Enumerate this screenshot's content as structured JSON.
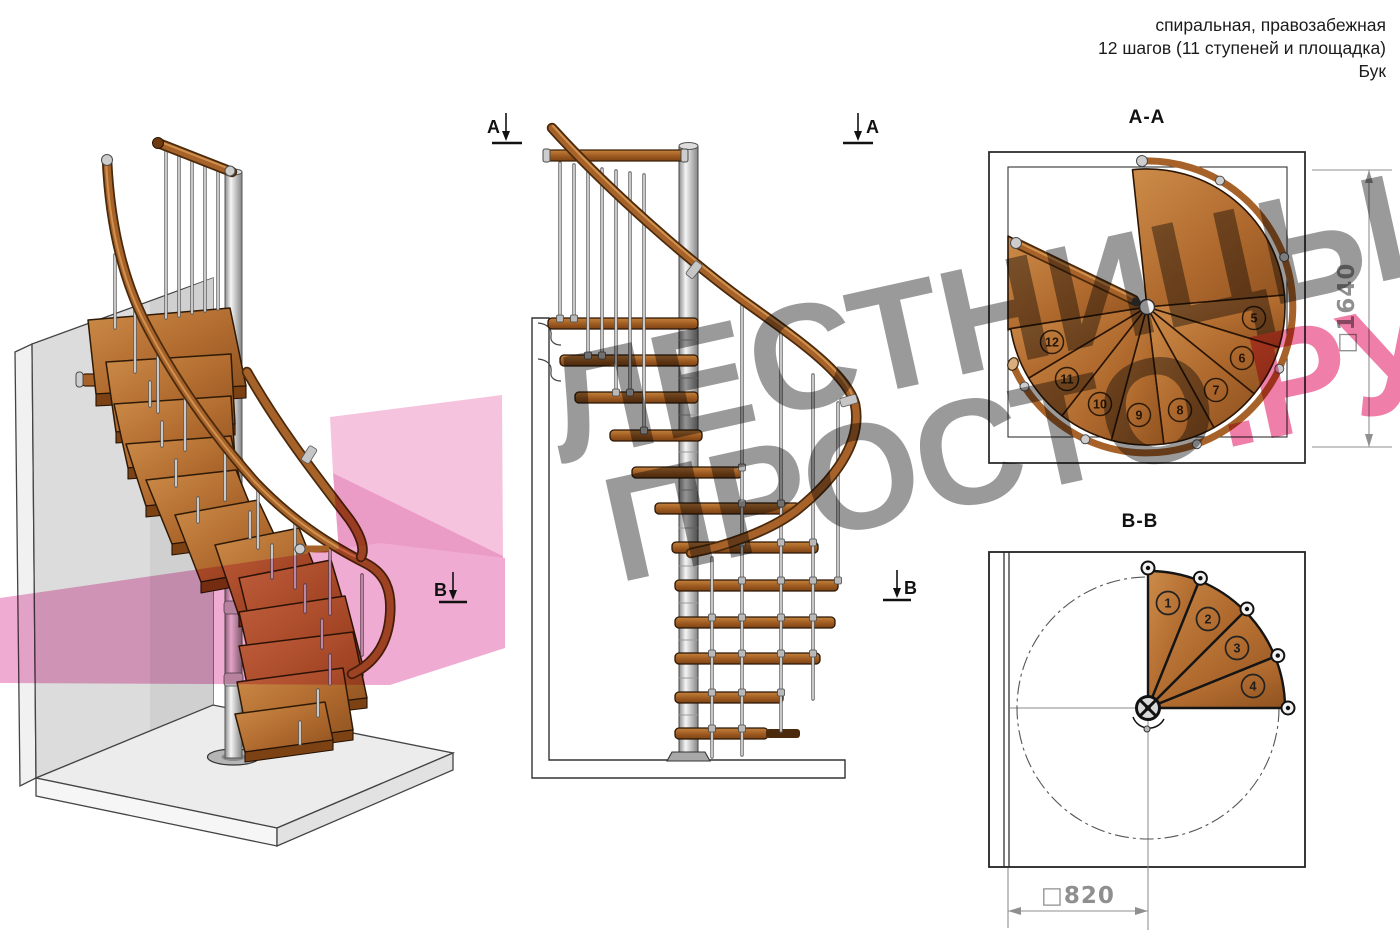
{
  "header": {
    "line1": "спиральная, правозабежная",
    "line2": "12 шагов (11 ступеней и площадка)",
    "line3": "Бук"
  },
  "watermark": {
    "line1": "ЛЕСТНИЦЫ",
    "line2_gray": "ПРОСТО",
    "line2_pink": ".РУ"
  },
  "markers": {
    "section_a_left": "A",
    "section_a_right": "A",
    "section_b_left": "B",
    "section_b_right": "B"
  },
  "section_aa": {
    "title": "A-A",
    "dimension": "□1640",
    "steps": [
      "5",
      "6",
      "7",
      "8",
      "9",
      "10",
      "11",
      "12"
    ]
  },
  "section_bb": {
    "title": "B-B",
    "dimension": "□820",
    "steps": [
      "1",
      "2",
      "3",
      "4"
    ]
  },
  "colors": {
    "wood": "#b06a33",
    "wood_dark": "#6f3a10",
    "metal": "#c9c9c9",
    "outline": "#1a1a1a",
    "watermark_gray": "#9a9a9a",
    "watermark_pink": "#ef7fa8",
    "overlay_pink": "#f0abd2"
  }
}
